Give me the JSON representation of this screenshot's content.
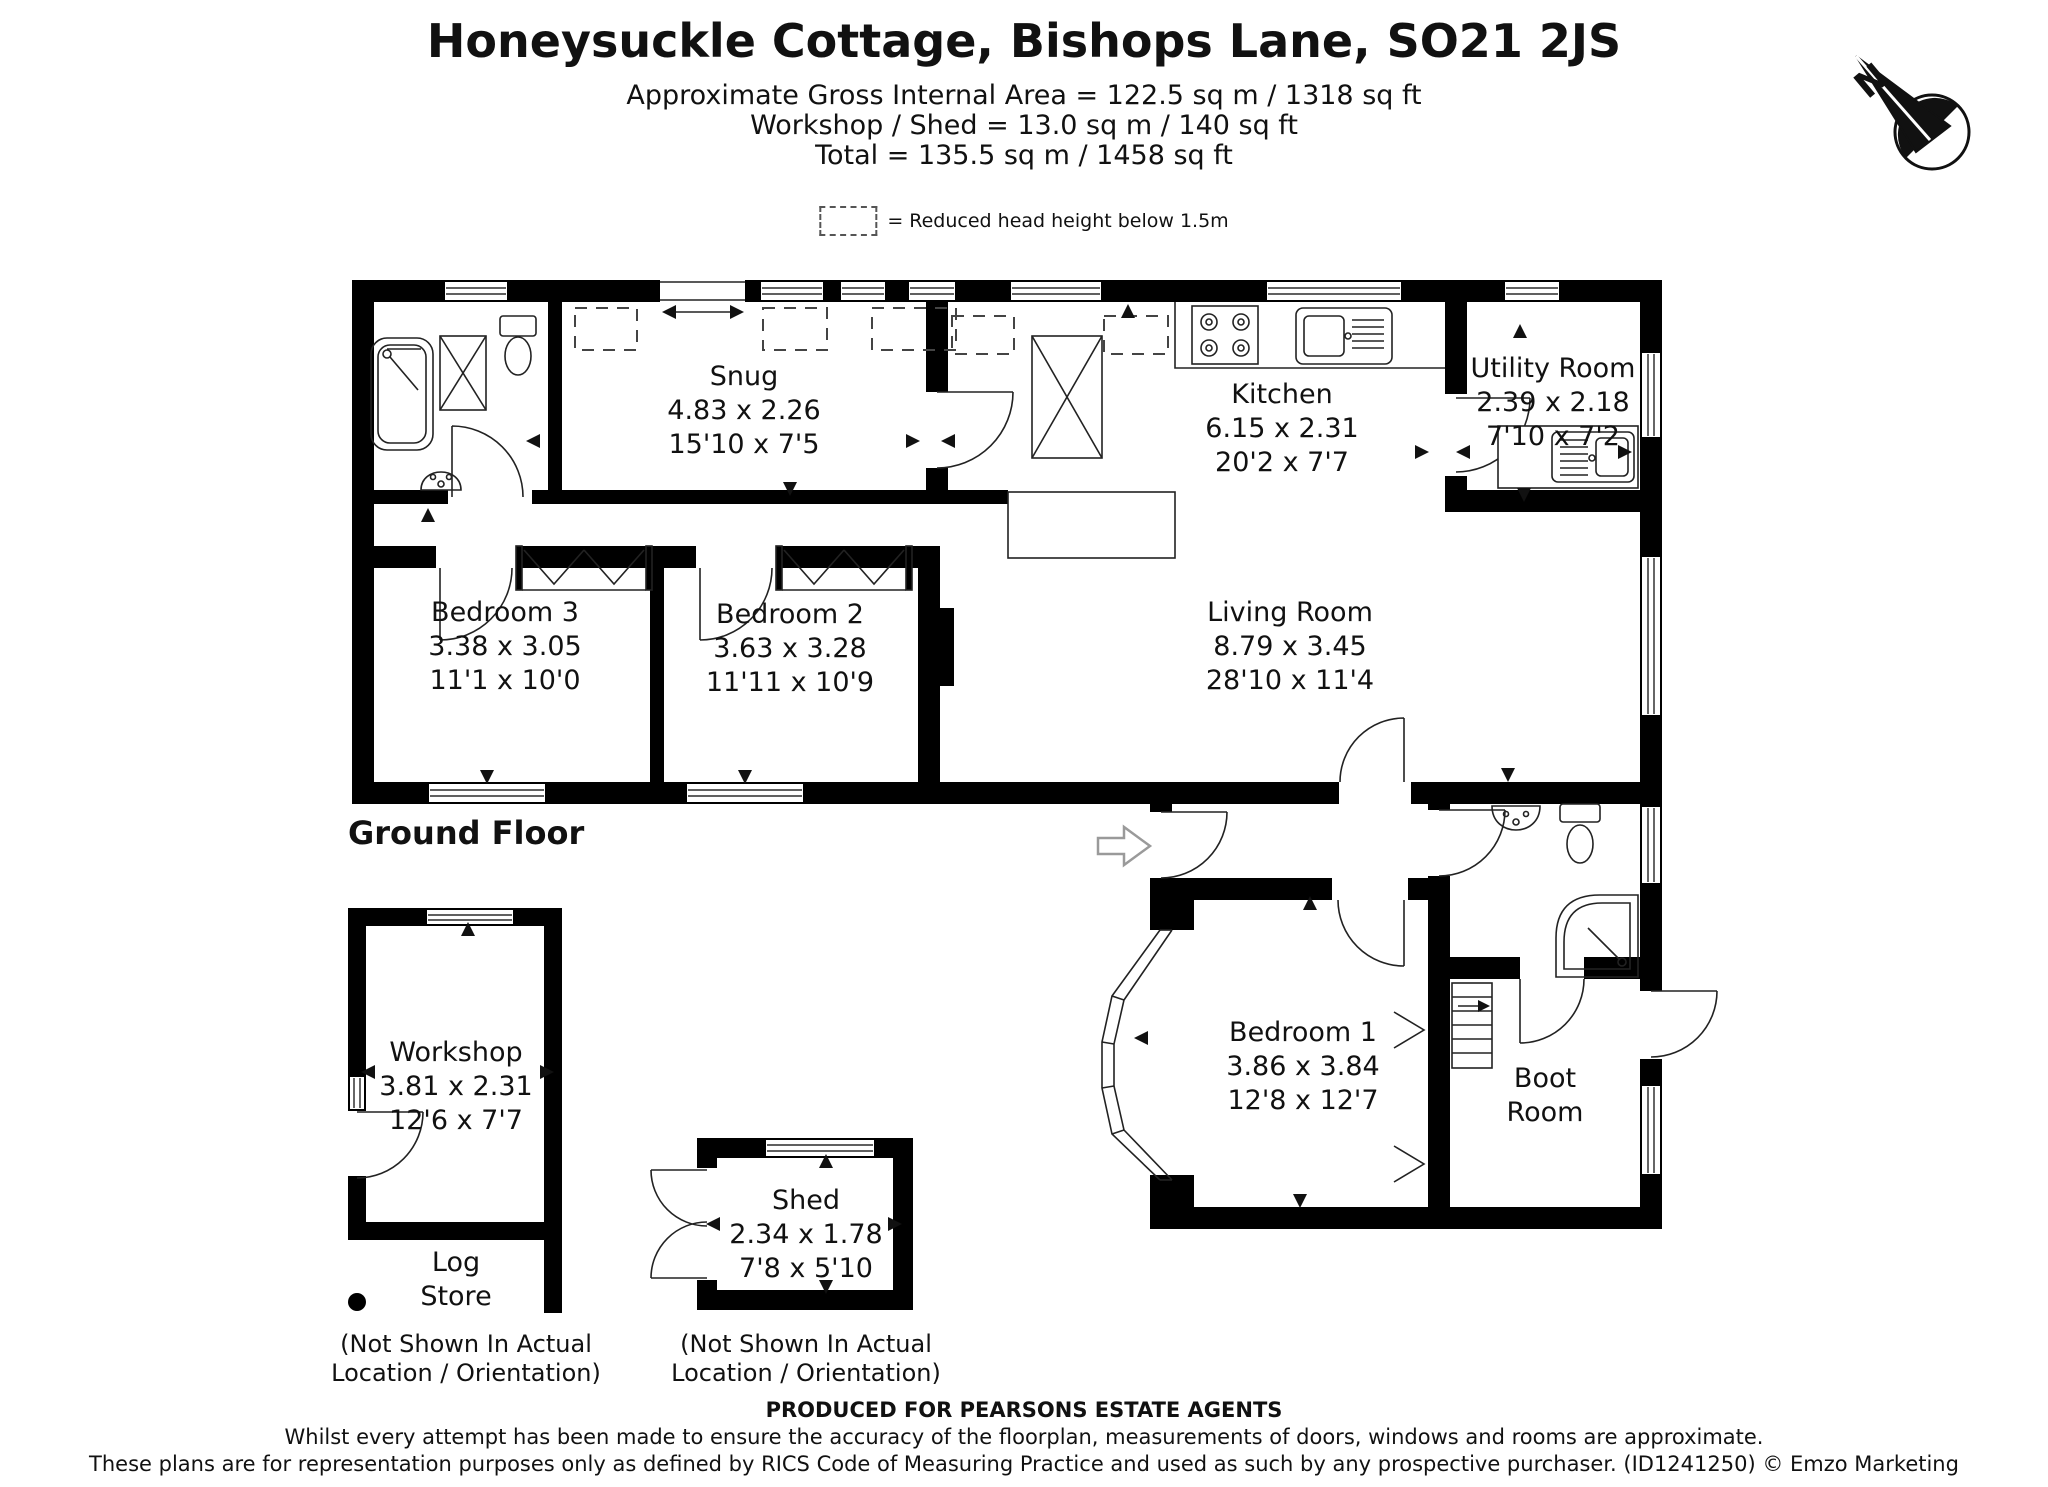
{
  "header": {
    "title": "Honeysuckle Cottage, Bishops Lane, SO21 2JS",
    "area_line": "Approximate Gross Internal Area = 122.5 sq m / 1318 sq ft",
    "workshop_line": "Workshop / Shed = 13.0 sq m / 140 sq ft",
    "total_line": "Total = 135.5 sq m / 1458 sq ft"
  },
  "legend": {
    "label": "= Reduced head height below 1.5m"
  },
  "compass": {
    "north": "N"
  },
  "floor": {
    "label": "Ground Floor"
  },
  "rooms": {
    "snug": {
      "name": "Snug",
      "metric": "4.83 x 2.26",
      "imperial": "15'10 x 7'5"
    },
    "kitchen": {
      "name": "Kitchen",
      "metric": "6.15 x 2.31",
      "imperial": "20'2 x 7'7"
    },
    "utility": {
      "name": "Utility Room",
      "metric": "2.39 x 2.18",
      "imperial": "7'10 x 7'2"
    },
    "bedroom3": {
      "name": "Bedroom 3",
      "metric": "3.38 x 3.05",
      "imperial": "11'1 x 10'0"
    },
    "bedroom2": {
      "name": "Bedroom 2",
      "metric": "3.63 x 3.28",
      "imperial": "11'11 x 10'9"
    },
    "living": {
      "name": "Living Room",
      "metric": "8.79 x 3.45",
      "imperial": "28'10 x 11'4"
    },
    "bedroom1": {
      "name": "Bedroom 1",
      "metric": "3.86 x 3.84",
      "imperial": "12'8 x 12'7"
    },
    "boot": {
      "line1": "Boot",
      "line2": "Room"
    },
    "workshop": {
      "name": "Workshop",
      "metric": "3.81 x 2.31",
      "imperial": "12'6 x 7'7"
    },
    "log_store": {
      "line1": "Log",
      "line2": "Store"
    },
    "shed": {
      "name": "Shed",
      "metric": "2.34 x 1.78",
      "imperial": "7'8 x 5'10"
    }
  },
  "notes": {
    "not_shown_line1": "(Not Shown In Actual",
    "not_shown_line2": "Location / Orientation)"
  },
  "footer": {
    "line1": "PRODUCED FOR PEARSONS ESTATE AGENTS",
    "line2": "Whilst every attempt has been made to ensure the accuracy of the floorplan, measurements of doors, windows and rooms are approximate.",
    "line3": "These plans are for representation purposes only as defined by RICS Code of Measuring Practice and used as such by any prospective purchaser. (ID1241250) © Emzo Marketing"
  }
}
